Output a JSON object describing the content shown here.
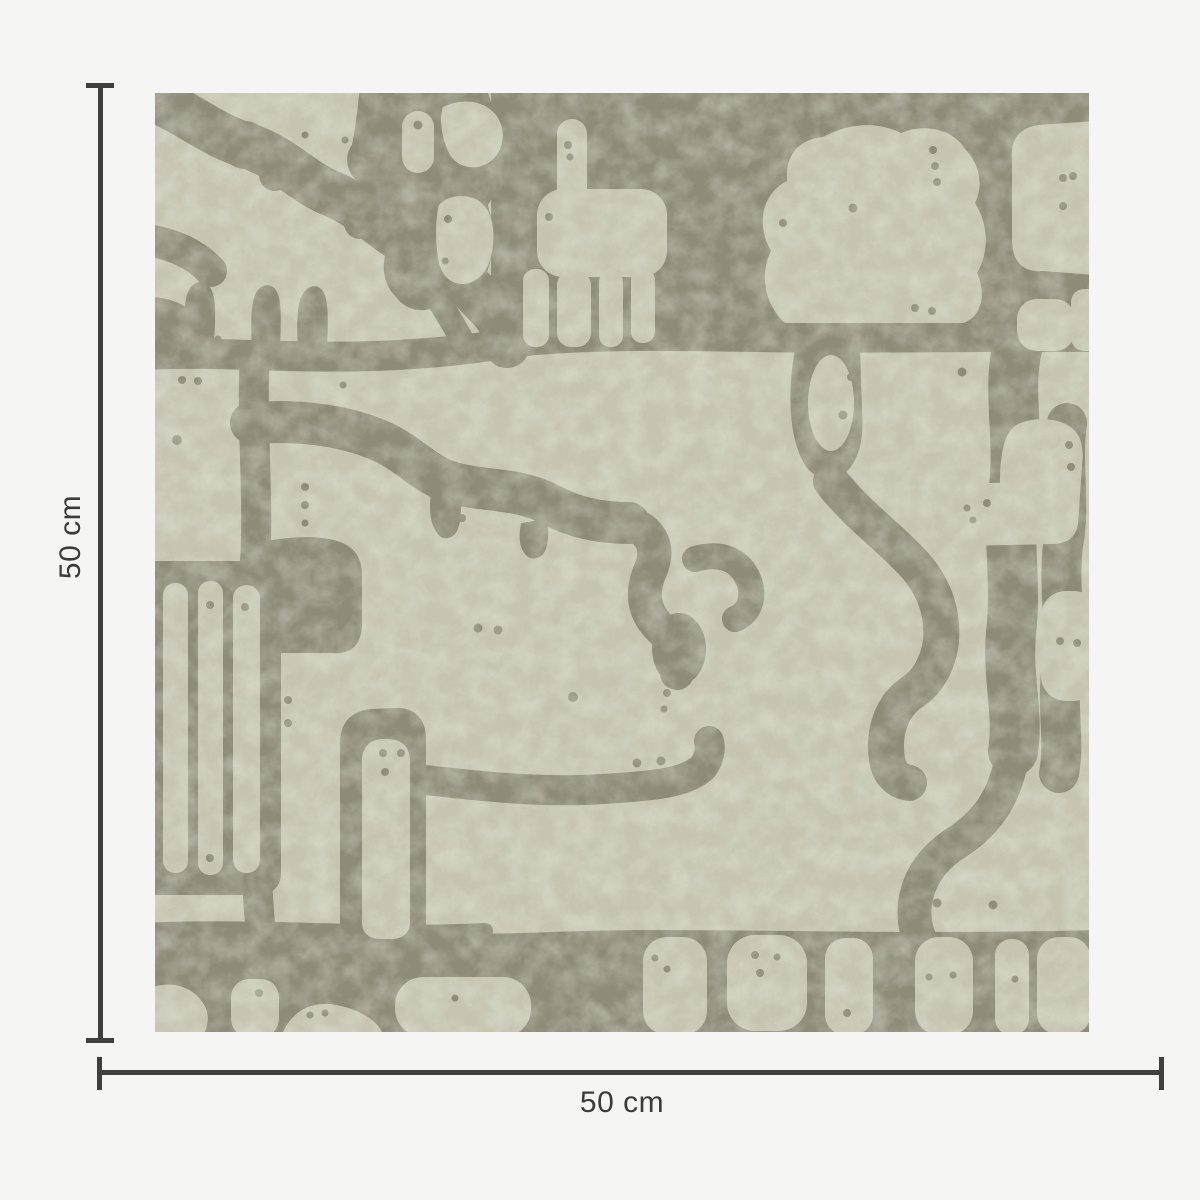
{
  "title": "Wallpaper swatch dimension diagram",
  "swatch": {
    "width_label": "50 cm",
    "height_label": "50 cm",
    "pattern_description": "Abstract organic blob pattern, light sage shapes divided by olive-gray channels with small dots"
  },
  "colors": {
    "page_bg": "#f5f5f3",
    "pattern_light": "#c8c6b2",
    "pattern_dark": "#8e8b78",
    "dimension_line": "#3f3f3f",
    "label_text": "#3b3b3b"
  }
}
